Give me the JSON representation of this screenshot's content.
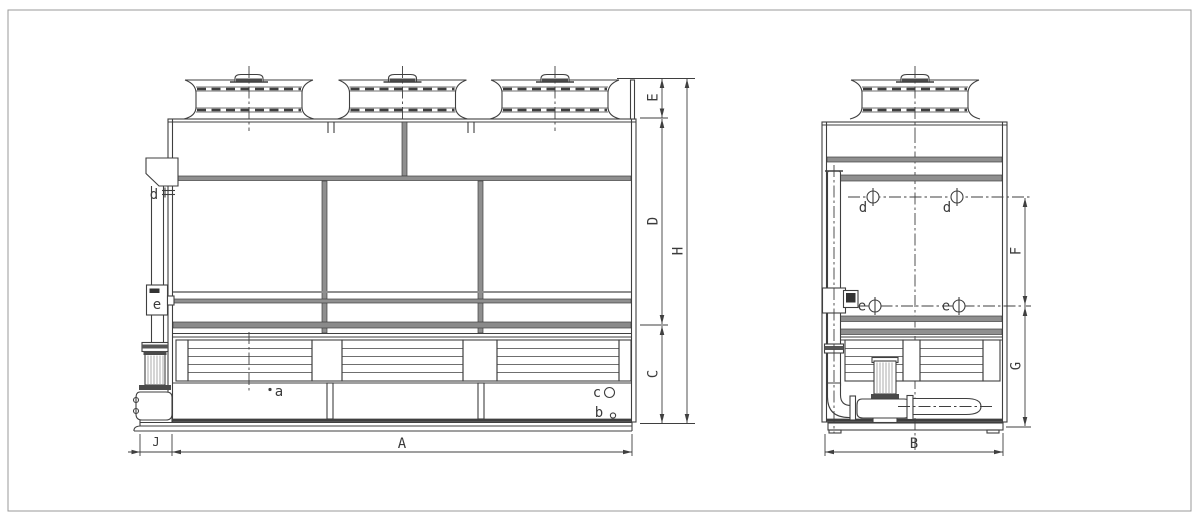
{
  "colors": {
    "line": "#3f3f3f",
    "rail_gray": "#8f8f8f",
    "band_gray": "#8a8a8a",
    "dark_fill": "#4a4a4a",
    "background": "#ffffff",
    "frame_border": "#999999"
  },
  "front_view": {
    "dim_labels": {
      "E": "E",
      "D": "D",
      "C": "C",
      "H": "H",
      "A": "A",
      "J": "J"
    },
    "port_labels": {
      "d": "d",
      "e": "e",
      "a": "a",
      "b": "b",
      "c": "c"
    }
  },
  "side_view": {
    "dim_labels": {
      "F": "F",
      "G": "G",
      "B": "B"
    },
    "port_labels": {
      "d_left": "d",
      "d_right": "d",
      "e_left": "e",
      "e_right": "e"
    }
  }
}
